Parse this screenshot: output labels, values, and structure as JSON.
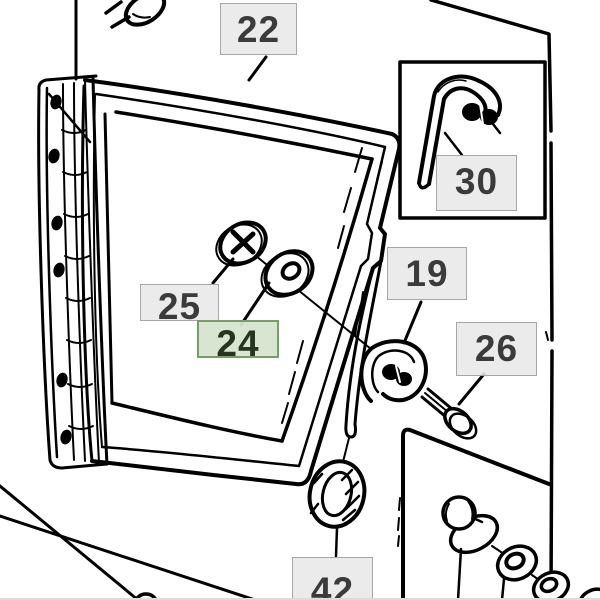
{
  "diagram": {
    "type": "parts-exploded-view",
    "background_color": "#ffffff",
    "line_color": "#000000",
    "labels": [
      {
        "id": "22",
        "text": "22",
        "highlighted": false
      },
      {
        "id": "30",
        "text": "30",
        "highlighted": false
      },
      {
        "id": "19",
        "text": "19",
        "highlighted": false
      },
      {
        "id": "26",
        "text": "26",
        "highlighted": false
      },
      {
        "id": "25",
        "text": "25",
        "highlighted": false
      },
      {
        "id": "24",
        "text": "24",
        "highlighted": true
      },
      {
        "id": "42",
        "text": "42",
        "highlighted": false
      }
    ],
    "colors": {
      "label_bg": "rgba(232,232,232,0.88)",
      "label_border": "#a6a6a6",
      "label_text": "#3b3b3b",
      "highlight_bg": "rgba(214,228,206,0.95)",
      "highlight_border": "#74a067",
      "highlight_text": "#26351f",
      "bottom_edge": "#dcdcdc"
    },
    "artwork_parts": [
      "window-hinge",
      "window-seal-frame",
      "glass-pane",
      "latch-strap",
      "hook-latch",
      "phillips-screw",
      "flat-washer",
      "mounting-screw",
      "rubber-grommet",
      "inset-detail-box",
      "j-bolt-hook",
      "bolt-washer-stack",
      "cab-panel-outline"
    ]
  }
}
